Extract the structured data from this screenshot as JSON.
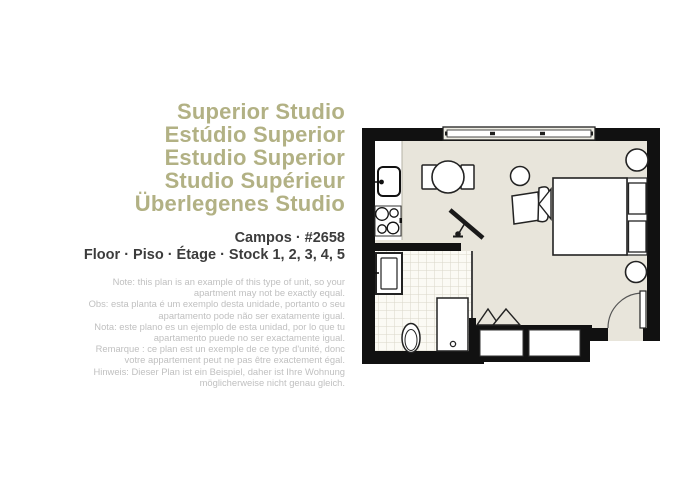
{
  "colors": {
    "accent_olive": "#b2b184",
    "subtitle_dark": "#3c3c3c",
    "note_gray": "#c0c0c0",
    "wall_black": "#111111",
    "floor_beige": "#e8e5db",
    "tile_white": "#fbfaf4",
    "tile_line": "#d9d6c9",
    "outline_dark": "#1f1f1f",
    "background": "#ffffff"
  },
  "title_block": {
    "lines": [
      "Superior Studio",
      "Estúdio Superior",
      "Estudio Superior",
      "Studio Supérieur",
      "Überlegenes Studio"
    ]
  },
  "unit_info": {
    "line1": "Campos · #2658",
    "line2": "Floor · Piso · Étage · Stock 1, 2, 3, 4, 5"
  },
  "disclaimer": {
    "lines": [
      "Note: this plan is an example of this type of unit, so your",
      "apartment may not be exactly equal.",
      "Obs: esta planta é um exemplo desta unidade, portanto o seu",
      "apartamento pode não ser exatamente igual.",
      "Nota: este plano es un ejemplo de esta unidad, por lo que tu",
      "apartamento puede no ser exactamente igual.",
      "Remarque : ce plan est un exemple de ce type d'unité, donc",
      "votre appartement peut ne pas être exactement égal.",
      "Hinweis: Dieser Plan ist ein Beispiel, daher ist Ihre Wohnung",
      "möglicherweise nicht genau gleich."
    ]
  },
  "floor_plan": {
    "elements": [
      "window",
      "kitchen-sink",
      "stove",
      "dining-table",
      "dining-chairs",
      "tv-on-stand",
      "armchair",
      "side-table",
      "double-bed",
      "pillows",
      "nightstands",
      "wall-lamp",
      "entry-door",
      "wall-closets",
      "hanger-racks",
      "bathroom-tiles",
      "bathroom-vanity",
      "toilet",
      "shower"
    ]
  }
}
